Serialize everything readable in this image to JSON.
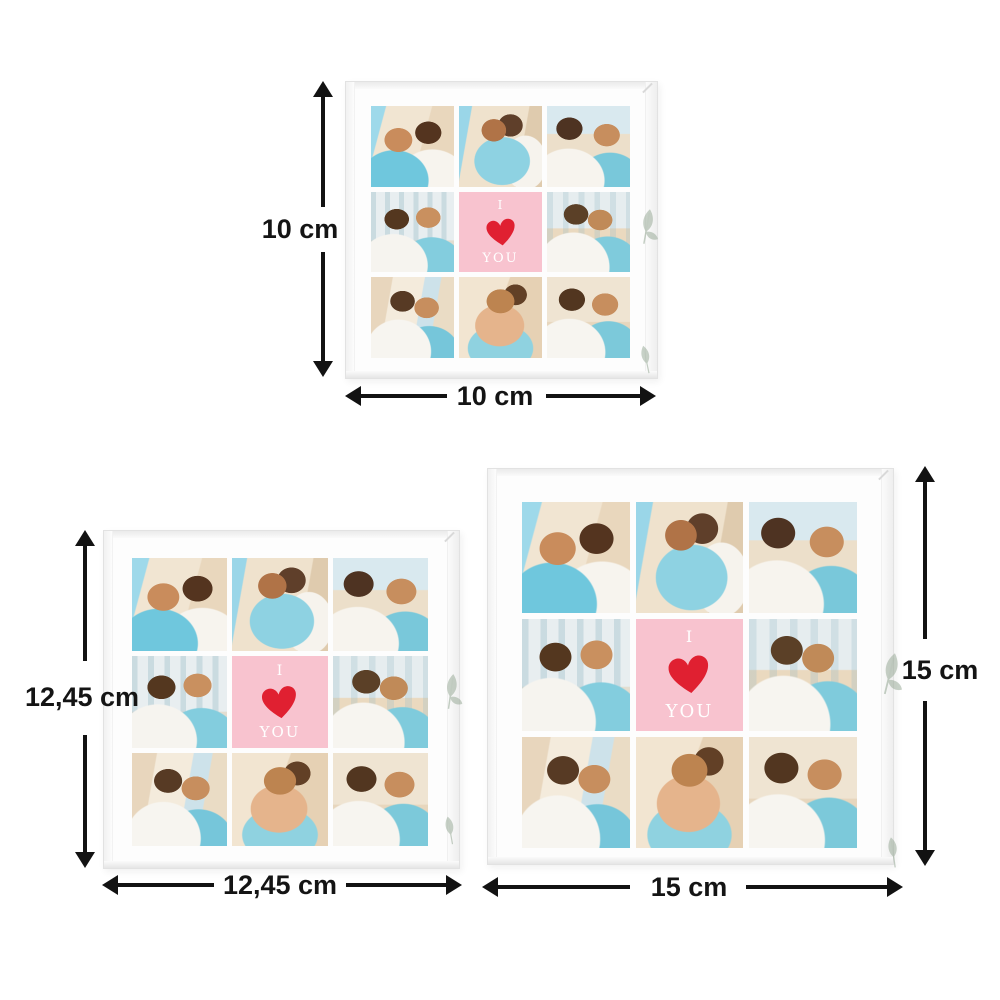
{
  "image": {
    "type": "product-size-diagram",
    "background_color": "#ffffff",
    "arrow_color": "#121212"
  },
  "collage": {
    "center_tile": {
      "line1": "I",
      "line2": "YOU",
      "heart_icon": "heart",
      "background_color": "#f8c3cf",
      "heart_color": "#e02031",
      "text_color": "#ffffff"
    },
    "photo_count_per_block": 8
  },
  "blocks": [
    {
      "name": "small",
      "height_label": "10 cm",
      "width_label": "10 cm"
    },
    {
      "name": "medium",
      "height_label": "12,45 cm",
      "width_label": "12,45 cm"
    },
    {
      "name": "large",
      "height_label": "15 cm",
      "width_label": "15 cm"
    }
  ],
  "icons": {
    "heart": "❤",
    "arrow_up": "▲",
    "arrow_down": "▼",
    "arrow_left": "◀",
    "arrow_right": "▶",
    "leaf": "🌿"
  }
}
